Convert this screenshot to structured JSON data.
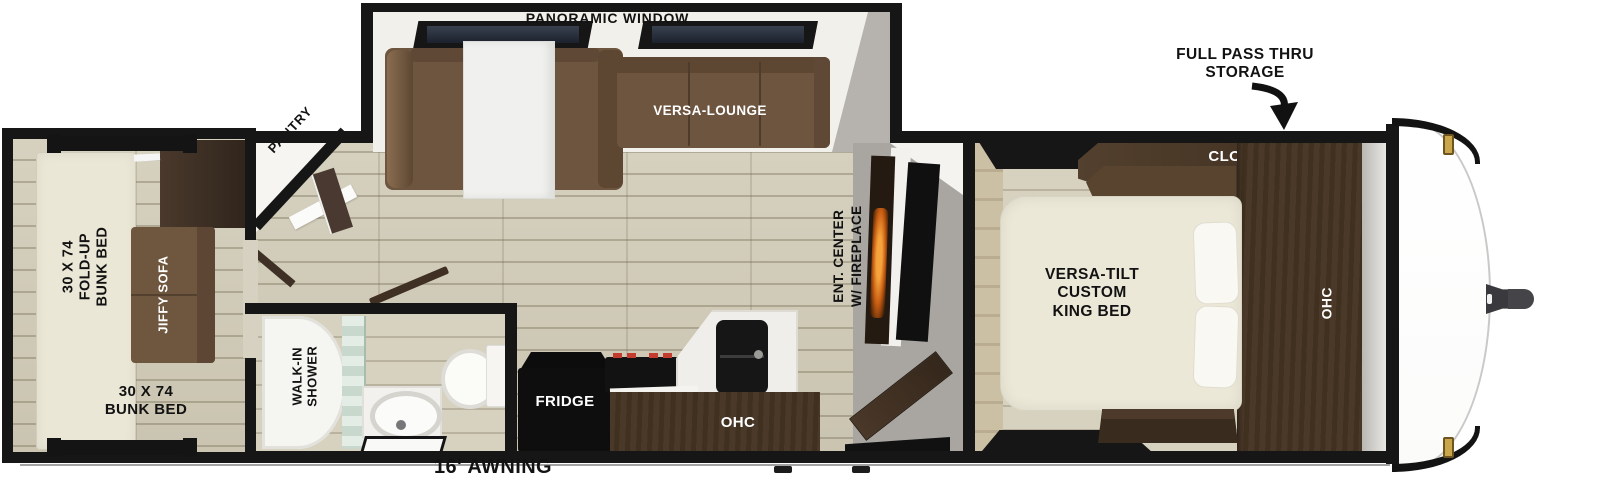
{
  "labels": {
    "panoramic_window": "PANORAMIC WINDOW",
    "versa_lounge": "VERSA-LOUNGE",
    "pantry": "PANTRY",
    "full_pass_thru": [
      "FULL PASS THRU",
      "STORAGE"
    ],
    "closet": "CLOSET",
    "king_bed": [
      "VERSA-TILT",
      "CUSTOM",
      "KING BED"
    ],
    "ohc_bedroom": "OHC",
    "ent_center": [
      "ENT. CENTER",
      "W/ FIREPLACE"
    ],
    "fridge": "FRIDGE",
    "ohc_kitchen": "OHC",
    "walk_in_shower": [
      "WALK-IN",
      "SHOWER"
    ],
    "fold_up_bunk": [
      "30 X 74",
      "FOLD-UP",
      "BUNK BED"
    ],
    "jiffy_sofa": "JIFFY SOFA",
    "bunk_bed": [
      "30 X 74",
      "BUNK BED"
    ],
    "awning": "16' AWNING"
  },
  "colors": {
    "wall": "#161616",
    "floor": "#d2ccb8",
    "sofa": "#6e5540",
    "cabinet_dark": "#42311f",
    "bed_cream": "#ece8d8",
    "flame": "#f5a33c",
    "glass": "#2a3140",
    "marker_light": "#caa64a"
  }
}
